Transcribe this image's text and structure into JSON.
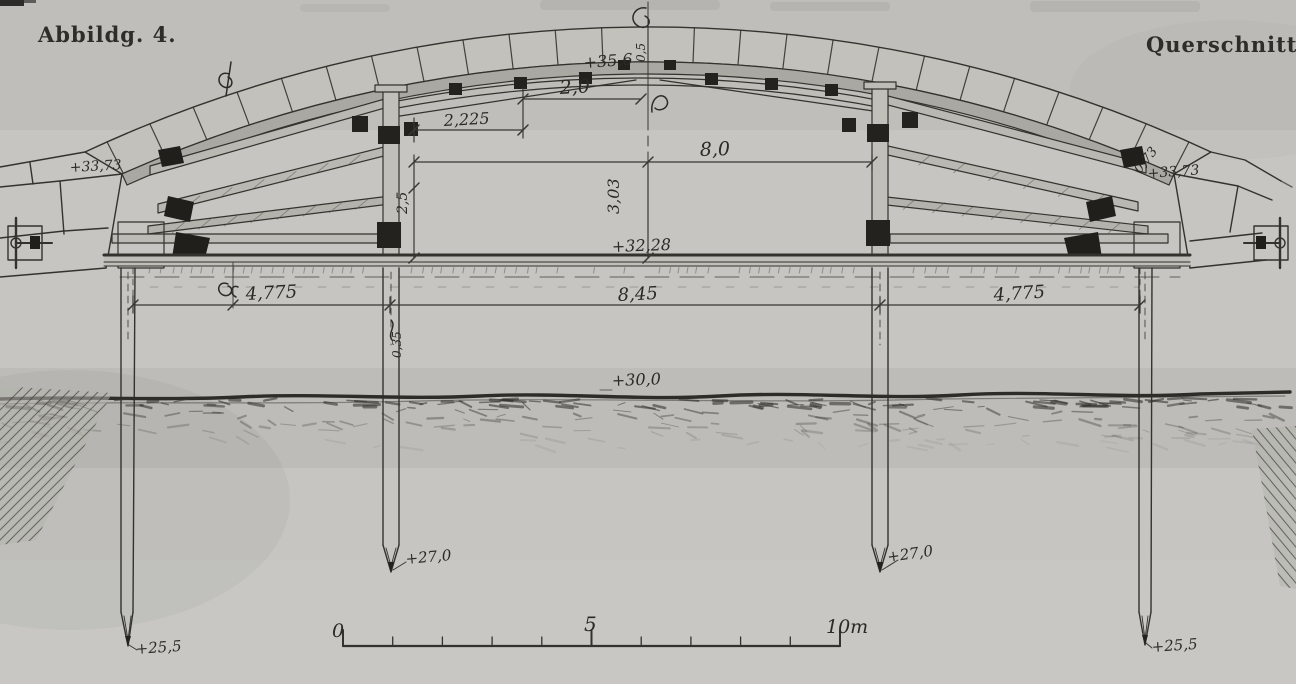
{
  "labels": {
    "figure": "Abbildg. 4.",
    "view": "Querschnitt."
  },
  "elevations": {
    "crown": "+35,6",
    "springing_left": "+33,73",
    "springing_right": "+33,73",
    "platform": "+32,28",
    "ground": "+30,0",
    "pile_inner_left": "+27,0",
    "pile_inner_right": "+27,0",
    "pile_outer_left": "+25,5",
    "pile_outer_right": "+25,5"
  },
  "dimensions": {
    "crown_half": "2,0",
    "crown_offset": "2,225",
    "upper_span": "8,0",
    "crown_height": "3,03",
    "post_height": "2,5",
    "bay_left": "4,775",
    "bay_center": "8,45",
    "bay_right": "4,775",
    "crown_packing": "0,5",
    "pile_width": "0,35",
    "ring_right": "0,73"
  },
  "scale_bar": {
    "zero": "0",
    "five": "5",
    "ten": "10m"
  }
}
